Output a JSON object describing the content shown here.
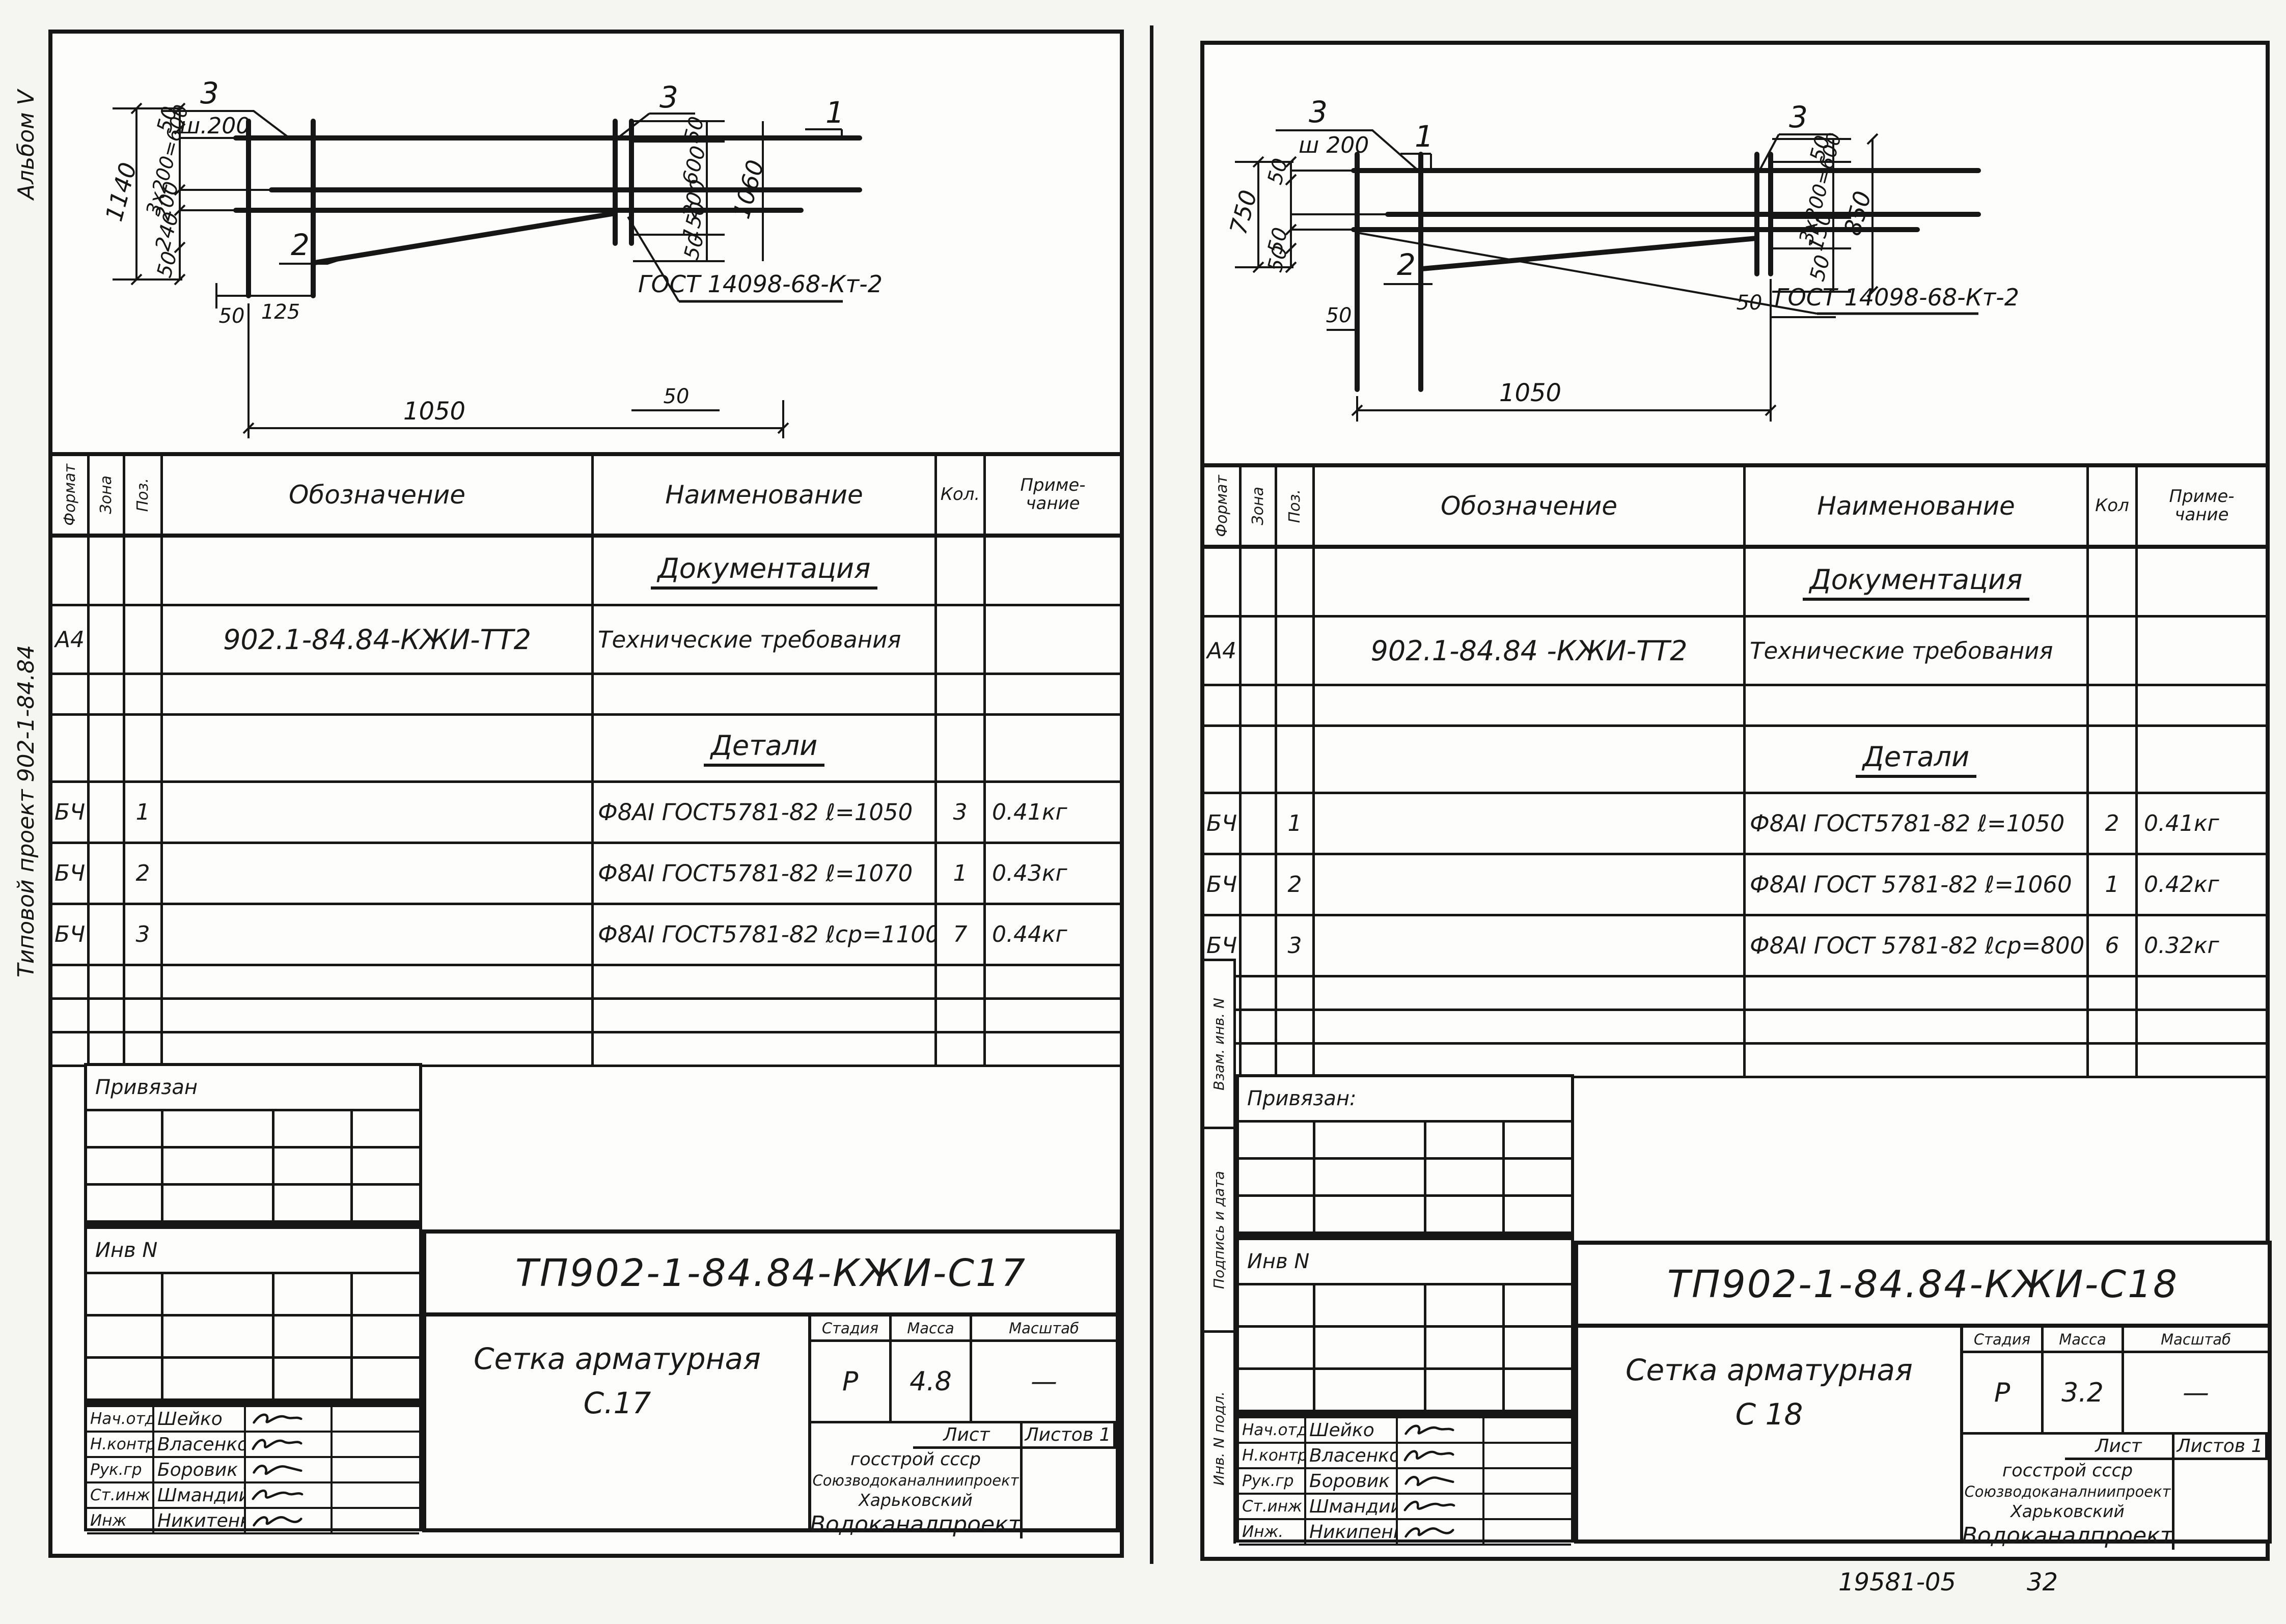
{
  "sheet": {
    "album_label": "Альбом V",
    "project_label": "Типовой проект 902-1-84.84",
    "footer_doc": "19581-05",
    "footer_page": "32"
  },
  "margin_labels": {
    "vzam": "Взам. инв. N",
    "podpis": "Подпись и дата",
    "inv_podl": "Инв. N подл."
  },
  "panels": [
    {
      "drawing": {
        "label1": "1",
        "label2": "2",
        "label3": "3",
        "label3b": "3",
        "step": "ш.200",
        "gost": "ГОСТ 14098-68-Кт-2",
        "left_overall": "1140",
        "left_parts": [
          "50",
          "3х200=600",
          "200",
          "240",
          "50"
        ],
        "right_parts": [
          "50",
          "600",
          "200",
          "150",
          "50"
        ],
        "right_overall": "1060",
        "bottom_parts": [
          "50",
          "125"
        ],
        "bottom_overall": "1050",
        "bottom_right": "50"
      },
      "table": {
        "col_format": "Формат",
        "col_zona": "Зона",
        "col_poz": "Поз.",
        "col_oboz": "Обозначение",
        "col_naim": "Наименование",
        "col_kol": "Кол.",
        "col_prim1": "Приме-",
        "col_prim2": "чание",
        "rows": [
          {
            "type": "section",
            "naim": "Документация"
          },
          {
            "format": "А4",
            "oboz": "902.1-84.84-КЖИ-ТТ2",
            "naim": "Технические требования"
          },
          {
            "type": "empty"
          },
          {
            "type": "section",
            "naim": "Детали"
          },
          {
            "format": "БЧ",
            "poz": "1",
            "naim": "Ф8АI ГОСТ5781-82 ℓ=1050",
            "kol": "3",
            "prim": "0.41кг"
          },
          {
            "format": "БЧ",
            "poz": "2",
            "naim": "Ф8АI ГОСТ5781-82 ℓ=1070",
            "kol": "1",
            "prim": "0.43кг"
          },
          {
            "format": "БЧ",
            "poz": "3",
            "naim": "Ф8АI ГОСТ5781-82 ℓср=1100",
            "kol": "7",
            "prim": "0.44кг"
          },
          {
            "type": "empty"
          },
          {
            "type": "empty"
          },
          {
            "type": "empty"
          }
        ]
      },
      "titleblock": {
        "privyazan": "Привязан",
        "inv_n": "Инв N",
        "doc": "ТП902-1-84.84-КЖИ-С17",
        "title1": "Сетка арматурная",
        "title2": "С.17",
        "stage_label": "Стадия",
        "mass_label": "Масса",
        "scale_label": "Масштаб",
        "stage": "Р",
        "mass": "4.8",
        "scale": "—",
        "sheet_label": "Лист",
        "sheets_label": "Листов 1",
        "org1": "госстрой ссср",
        "org2": "Союзводоканалниипроект",
        "org3": "Харьковский",
        "org4": "Водоканалпроект",
        "signers": [
          {
            "role": "Нач.отд",
            "name": "Шейко"
          },
          {
            "role": "Н.контр",
            "name": "Власенко"
          },
          {
            "role": "Рук.гр",
            "name": "Боровик"
          },
          {
            "role": "Ст.инж",
            "name": "Шмандий"
          },
          {
            "role": "Инж",
            "name": "Никитенко ЕМ"
          }
        ]
      }
    },
    {
      "drawing": {
        "label1": "1",
        "label2": "2",
        "label3": "3",
        "label3b": "3",
        "step": "ш 200",
        "gost": "ГОСТ 14098-68-Кт-2",
        "left_overall": "750",
        "left_parts": [
          "50",
          "50",
          "50"
        ],
        "right_parts": [
          "50",
          "3х200=600",
          "150",
          "50"
        ],
        "right_overall": "850",
        "bottom_parts": [
          "50"
        ],
        "bottom_overall": "1050",
        "bottom_right": "50"
      },
      "table": {
        "col_format": "Формат",
        "col_zona": "Зона",
        "col_poz": "Поз.",
        "col_oboz": "Обозначение",
        "col_naim": "Наименование",
        "col_kol": "Кол",
        "col_prim1": "Приме-",
        "col_prim2": "чание",
        "rows": [
          {
            "type": "section",
            "naim": "Документация"
          },
          {
            "format": "А4",
            "oboz": "902.1-84.84 -КЖИ-ТТ2",
            "naim": "Технические требования"
          },
          {
            "type": "empty"
          },
          {
            "type": "section",
            "naim": "Детали"
          },
          {
            "format": "БЧ",
            "poz": "1",
            "naim": "Ф8АI ГОСТ5781-82 ℓ=1050",
            "kol": "2",
            "prim": "0.41кг"
          },
          {
            "format": "БЧ",
            "poz": "2",
            "naim": "Ф8АI ГОСТ 5781-82 ℓ=1060",
            "kol": "1",
            "prim": "0.42кг"
          },
          {
            "format": "БЧ",
            "poz": "3",
            "naim": "Ф8АI ГОСТ 5781-82 ℓср=800",
            "kol": "6",
            "prim": "0.32кг"
          },
          {
            "type": "empty"
          },
          {
            "type": "empty"
          },
          {
            "type": "empty"
          }
        ]
      },
      "titleblock": {
        "privyazan": "Привязан:",
        "inv_n": "Инв N",
        "doc": "ТП902-1-84.84-КЖИ-С18",
        "title1": "Сетка арматурная",
        "title2": "С 18",
        "stage_label": "Стадия",
        "mass_label": "Масса",
        "scale_label": "Масштаб",
        "stage": "Р",
        "mass": "3.2",
        "scale": "—",
        "sheet_label": "Лист",
        "sheets_label": "Листов 1",
        "org1": "госстрой ссср",
        "org2": "Союзводоканалниипроект",
        "org3": "Харьковский",
        "org4": "Водоканалпроект",
        "signers": [
          {
            "role": "Нач.отд",
            "name": "Шейко"
          },
          {
            "role": "Н.контр",
            "name": "Власенко"
          },
          {
            "role": "Рук.гр",
            "name": "Боровик"
          },
          {
            "role": "Ст.инж",
            "name": "Шмандий"
          },
          {
            "role": "Инж.",
            "name": "Никипенко ЕМ"
          }
        ]
      }
    }
  ]
}
